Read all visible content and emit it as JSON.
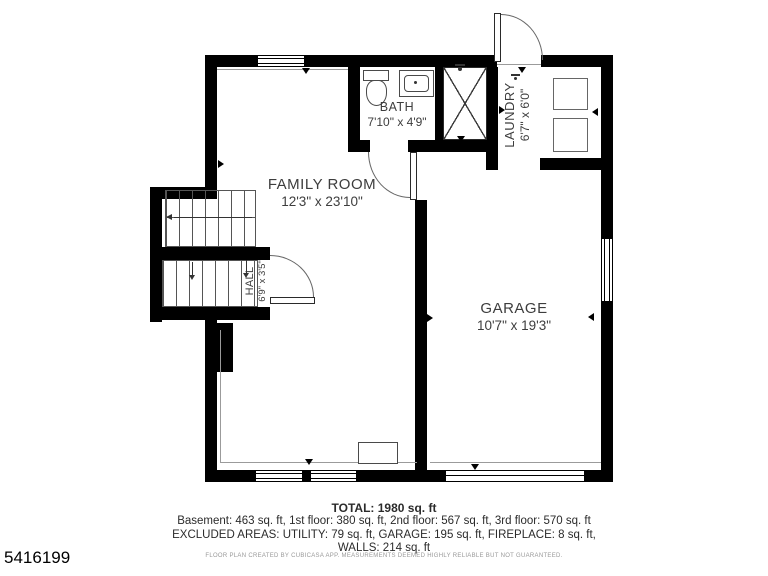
{
  "floor_plan": {
    "rooms": [
      {
        "id": "family-room",
        "name": "FAMILY ROOM",
        "dims": "12'3\" x 23'10\""
      },
      {
        "id": "bath",
        "name": "BATH",
        "dims": "7'10\" x 4'9\""
      },
      {
        "id": "laundry",
        "name": "LAUNDRY",
        "dims": "6'7\" x 6'0\""
      },
      {
        "id": "hall",
        "name": "HALL",
        "dims": "6'9\" x 3'5\""
      },
      {
        "id": "garage",
        "name": "GARAGE",
        "dims": "10'7\" x 19'3\""
      }
    ],
    "features": [
      "entry-door",
      "bath-door",
      "hall-door",
      "shower",
      "toilet",
      "sink",
      "washer",
      "dryer",
      "staircase-up",
      "staircase-down",
      "fireplace",
      "garage-door",
      "window"
    ]
  },
  "summary": {
    "total": "TOTAL: 1980 sq. ft",
    "floor_breakdown": "Basement: 463 sq. ft, 1st floor: 380 sq. ft, 2nd floor: 567 sq. ft, 3rd floor: 570 sq. ft",
    "excluded_areas": "EXCLUDED AREAS: UTILITY: 79 sq. ft, GARAGE: 195 sq. ft, FIREPLACE: 8 sq. ft,",
    "walls": "WALLS: 214 sq. ft",
    "disclaimer": "FLOOR PLAN CREATED BY CUBICASA APP. MEASUREMENTS DEEMED HIGHLY RELIABLE BUT NOT GUARANTEED."
  },
  "listing_id": "5416199",
  "colors": {
    "wall": "#000000",
    "label_text": "#3d3d3d",
    "summary_text": "#2b2b2b",
    "disclaimer_text": "#999999"
  }
}
